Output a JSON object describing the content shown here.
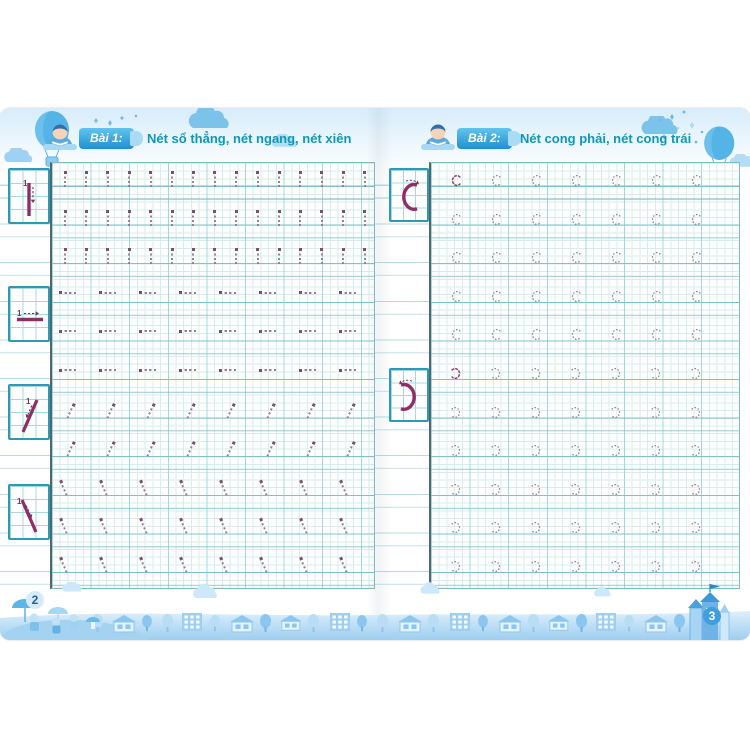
{
  "book": {
    "pages": [
      {
        "page_number": "2",
        "lesson_badge": "Bài 1:",
        "lesson_title": "Nét sổ thẳng, nét ngang, nét xiên",
        "sections": [
          {
            "stroke": "net-so-thang-vertical-bar",
            "glyph": "bar",
            "rows": 3,
            "glyphs_per_row": 15
          },
          {
            "stroke": "net-ngang-horizontal-dash",
            "glyph": "dash",
            "rows": 3,
            "glyphs_per_row": 8
          },
          {
            "stroke": "net-xien-forward-slash",
            "glyph": "slash",
            "rows": 2,
            "glyphs_per_row": 8
          },
          {
            "stroke": "net-xien-back-slash",
            "glyph": "backslash",
            "rows": 3,
            "glyphs_per_row": 8
          }
        ],
        "examples": [
          {
            "glyph": "bar",
            "step_label": "1"
          },
          {
            "glyph": "dash",
            "step_label": "1"
          },
          {
            "glyph": "slash",
            "step_label": "1"
          },
          {
            "glyph": "backslash",
            "step_label": "1"
          }
        ]
      },
      {
        "page_number": "3",
        "lesson_badge": "Bài 2:",
        "lesson_title": "Nét cong phải, nét cong trái",
        "sections": [
          {
            "stroke": "net-cong-phai-c-curve",
            "glyph": "c",
            "rows": 5,
            "glyphs_per_row": 7
          },
          {
            "stroke": "net-cong-trai-reversed-c-curve",
            "glyph": "rc",
            "rows": 6,
            "glyphs_per_row": 7
          }
        ],
        "examples": [
          {
            "glyph": "c",
            "step_label": ""
          },
          {
            "glyph": "rc",
            "step_label": ""
          }
        ]
      }
    ]
  },
  "colors": {
    "badge_blue_top": "#62c4ee",
    "badge_blue_bottom": "#1f8fd0",
    "title_teal": "#0f98b6",
    "stroke_magenta": "#8d2e66",
    "guide_label_purple": "#7b3360",
    "trace_purple": "#9d7f93",
    "trace_lead": "#8e3f6d",
    "grid_light_teal": "#d9eeea",
    "grid_strong_teal": "#7cbdc8",
    "footer_blue": "#8cc6ee",
    "sky_blue": "#d7ecfa"
  }
}
